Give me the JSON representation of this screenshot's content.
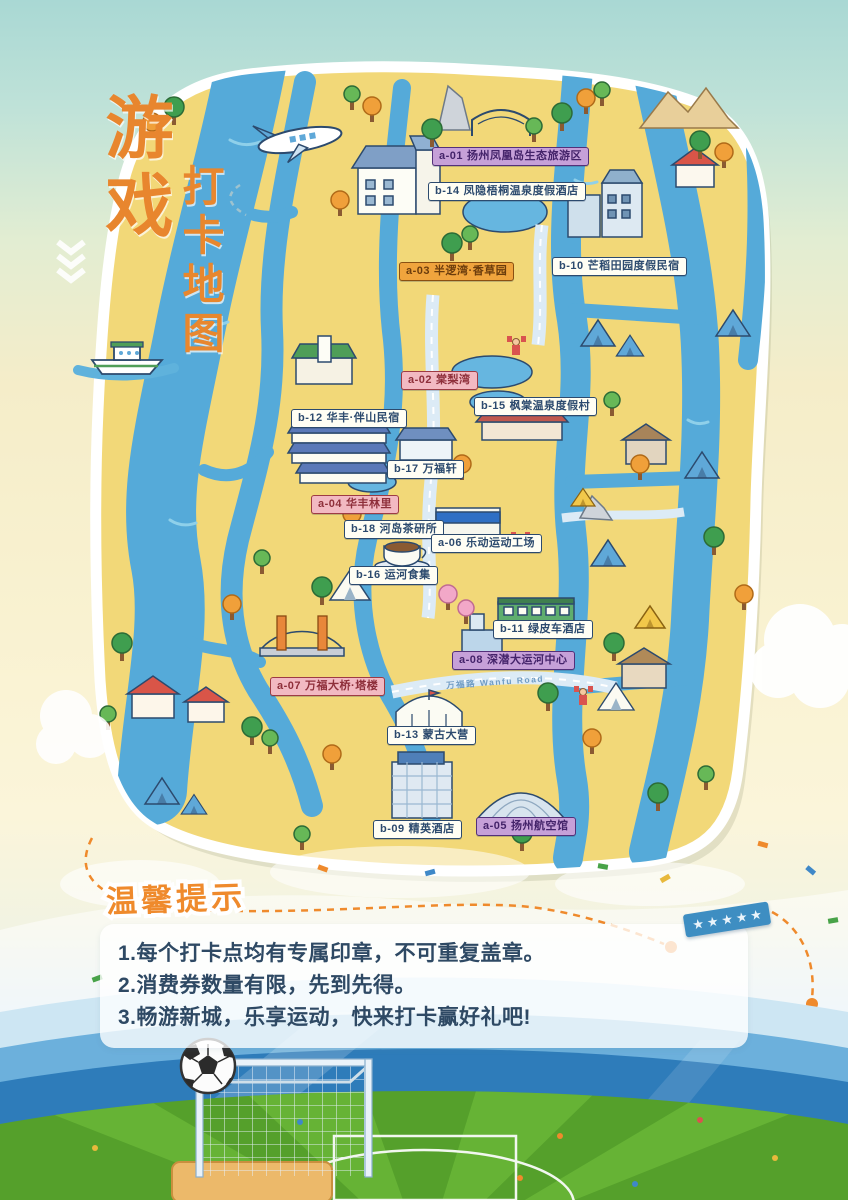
{
  "poster": {
    "title_main": "游戏",
    "title_sub": "打卡地图"
  },
  "map": {
    "road_label": "万福路 Wanfu Road",
    "labels": [
      {
        "code": "a-01",
        "name": "扬州凤凰岛生态旅游区",
        "variant": "purple"
      },
      {
        "code": "b-14",
        "name": "凤隐梧桐温泉度假酒店",
        "variant": "white"
      },
      {
        "code": "a-03",
        "name": "半逻湾·香草园",
        "variant": "orange"
      },
      {
        "code": "b-10",
        "name": "芒稻田园度假民宿",
        "variant": "white"
      },
      {
        "code": "a-02",
        "name": "棠梨湾",
        "variant": "pink"
      },
      {
        "code": "b-12",
        "name": "华丰·伴山民宿",
        "variant": "white"
      },
      {
        "code": "b-15",
        "name": "枫棠温泉度假村",
        "variant": "white"
      },
      {
        "code": "b-17",
        "name": "万福轩",
        "variant": "white"
      },
      {
        "code": "a-04",
        "name": "华丰林里",
        "variant": "pink"
      },
      {
        "code": "b-18",
        "name": "河岛茶研所",
        "variant": "white"
      },
      {
        "code": "a-06",
        "name": "乐动运动工场",
        "variant": "white"
      },
      {
        "code": "b-16",
        "name": "运河食集",
        "variant": "white"
      },
      {
        "code": "b-11",
        "name": "绿皮车酒店",
        "variant": "white"
      },
      {
        "code": "a-08",
        "name": "深潜大运河中心",
        "variant": "purple"
      },
      {
        "code": "a-07",
        "name": "万福大桥·塔楼",
        "variant": "pink"
      },
      {
        "code": "b-13",
        "name": "蒙古大营",
        "variant": "white"
      },
      {
        "code": "b-09",
        "name": "精英酒店",
        "variant": "white"
      },
      {
        "code": "a-05",
        "name": "扬州航空馆",
        "variant": "purple"
      }
    ]
  },
  "tips": {
    "title": "温馨提示",
    "items": [
      "1.每个打卡点均有专属印章，不可重复盖章。",
      "2.消费券数量有限，先到先得。",
      "3.畅游新城，乐享运动，快来打卡赢好礼吧!"
    ]
  },
  "ribbon": {
    "star_glyph": "★"
  },
  "colors": {
    "land": "#f2d878",
    "water": "#55aad9",
    "accent_orange": "#e8862e",
    "tips_text": "#2e4964",
    "ribbon_blue": "#3e8ec2"
  }
}
